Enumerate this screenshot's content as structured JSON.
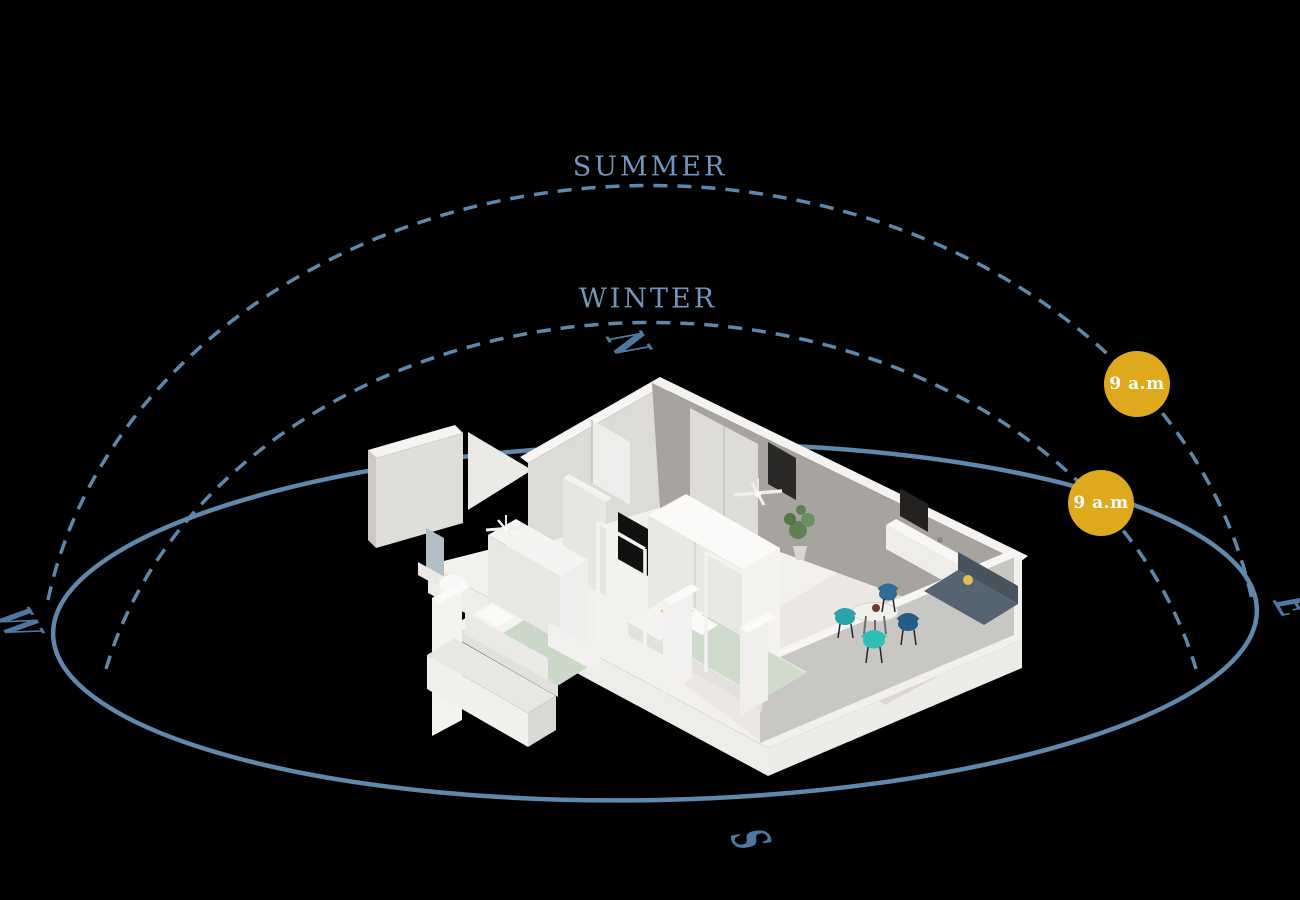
{
  "background_color": "#000000",
  "sun_paths": {
    "line_color": "#5d87ab",
    "label_color": "#7295bb",
    "summer": {
      "label": "SUMMER"
    },
    "winter": {
      "label": "WINTER"
    }
  },
  "compass": {
    "color": "#4e78a0",
    "north": "N",
    "east": "E",
    "south": "S",
    "west": "W"
  },
  "sun_markers": {
    "fill_color": "#dfa91d",
    "text_color": "#ffffff",
    "summer": {
      "label": "9 a.m"
    },
    "winter": {
      "label": "9 a.m"
    }
  },
  "house": {
    "description": "isometric cutaway apartment floor plan render",
    "accent_colors": {
      "walls": "#f3f2f0",
      "wall_shadow": "#a7a39f",
      "bed_blanket": "#cfdccb",
      "pillow_yellow": "#e8c75e",
      "chair_teal": "#2fbfb7",
      "chair_blue": "#275e84",
      "plant_green": "#5d8154"
    }
  }
}
